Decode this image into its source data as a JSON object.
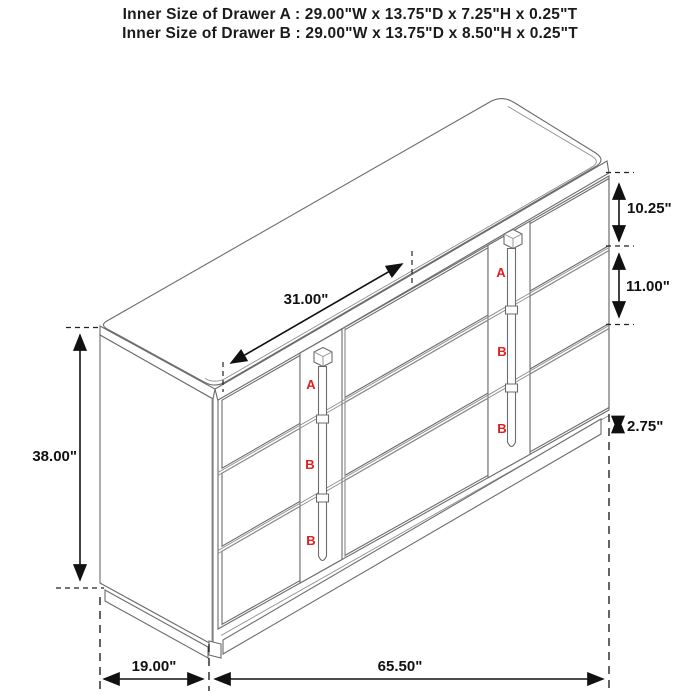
{
  "title": {
    "line1": "Inner Size of Drawer A : 29.00\"W x 13.75\"D x 7.25\"H x 0.25\"T",
    "line2": "Inner Size of Drawer B : 29.00\"W x 13.75\"D x 8.50\"H x 0.25\"T"
  },
  "dimensions": {
    "middle_section_width": "31.00\"",
    "drawer_a_height": "10.25\"",
    "drawer_b_height": "11.00\"",
    "base_height": "2.75\"",
    "overall_height": "38.00\"",
    "depth": "19.00\"",
    "overall_width": "65.50\""
  },
  "drawer_labels": {
    "a": "A",
    "b": "B"
  },
  "colors": {
    "outline": "#6b6b6b",
    "flute": "#9c9c9c",
    "dimension_ink": "#111111",
    "drawer_label_red": "#e01f1f",
    "background": "#ffffff"
  }
}
